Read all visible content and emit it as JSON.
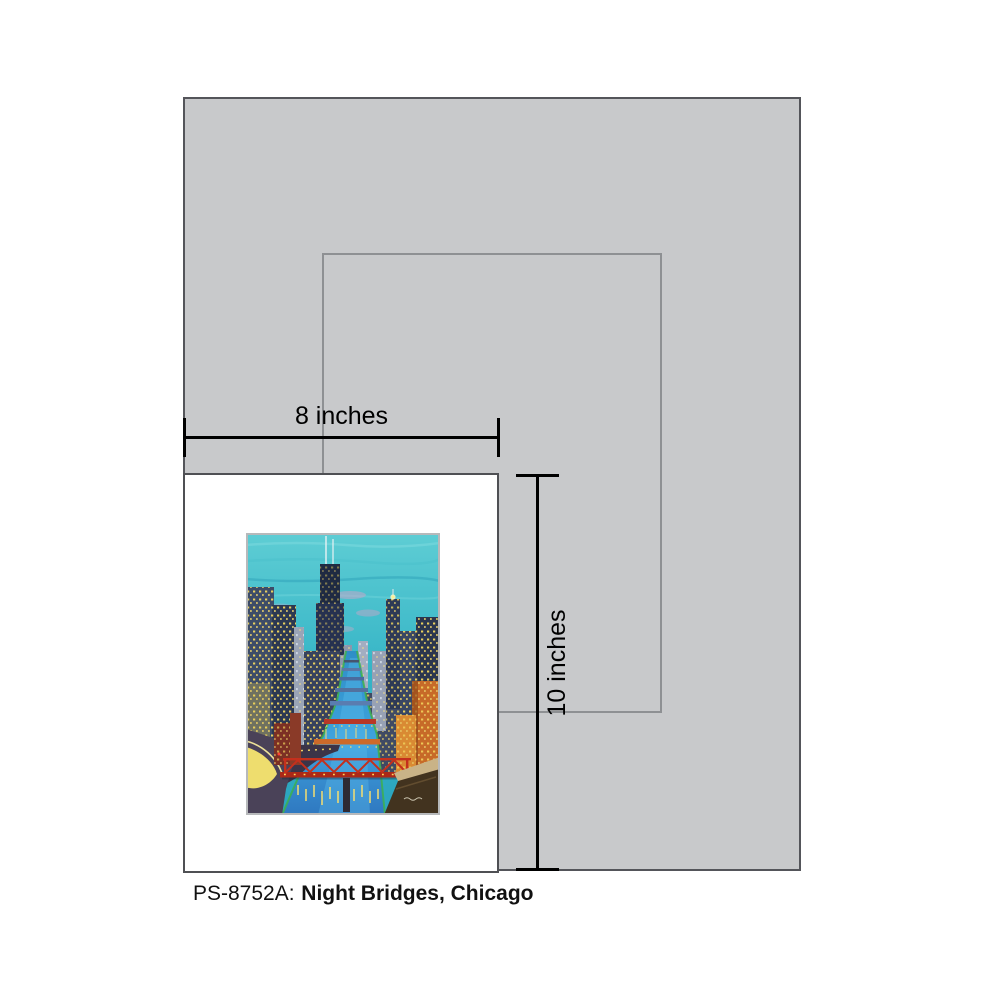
{
  "product": {
    "sku_label": "PS-8752A:",
    "title": "Night Bridges, Chicago"
  },
  "dimension_annotations": {
    "width": "8 inches",
    "height": "10 inches"
  },
  "artwork": {
    "subject": "night cityscape of Chicago river with bridges and lit skyscrapers"
  },
  "colors": {
    "page_background": "#ffffff",
    "mat_gray": "#c8c9cb",
    "mat_border": "#54555a",
    "opening_outline": "#8e9093",
    "print_white": "#ffffff",
    "print_border": "#4f5054",
    "dimension_line": "#000000",
    "caption_text": "#111111",
    "painting_sky_teal": "#35b4c6",
    "painting_river_blue": "#3fa3de",
    "painting_bridge_red": "#c4301d",
    "painting_window_yellow": "#f2d75e"
  }
}
